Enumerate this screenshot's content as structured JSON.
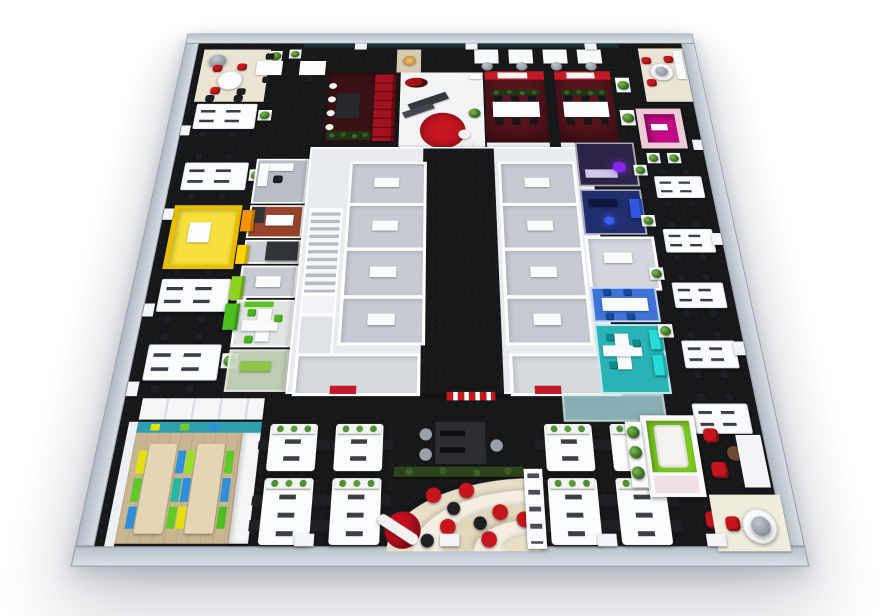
{
  "scene": {
    "kind": "3d-office-floor-plan-aerial-render",
    "background": "#ffffff"
  },
  "palette": {
    "floor_dark": "#17181a",
    "core_white": "#e9ecef",
    "room_gray": "#c6cbd3",
    "accent_red": "#c21a28",
    "rug_red": "#c81622",
    "red_room_floor": "#5a141d",
    "booth_red": "#a31220",
    "nook_floor_maroon": "#3a1216",
    "magenta": "#c30b86",
    "pink_wall": "#eccbd6",
    "purple_floor": "#2c2447",
    "purple_lamp": "#8227ec",
    "navy_floor": "#202e6e",
    "blue_bright": "#2f54e0",
    "blue_room_floor": "#3f74d6",
    "teal_room_floor": "#2ab3b6",
    "cyan_bright": "#25dcd8",
    "teal_glass": "#9cc7cd",
    "sage": "#ccdcc0",
    "orange_room_floor": "#96432b",
    "orange_bright": "#f59300",
    "yellow_pod": "#f7df3d",
    "yellow_pod_wall": "#e8be00",
    "yellow_bright": "#ffd40a",
    "lime_bright": "#8ad41c",
    "green_bright": "#4cbe1e",
    "green_pod": "#7cc820",
    "lime_table": "#9ad44c",
    "wood_floor": "#c9b691",
    "wood_table": "#e4d6b4",
    "teal_wall": "#2f9fae",
    "bench_yellow": "#e3e00e",
    "bench_green": "#5ec929",
    "bench_blue": "#2f8fd8",
    "bench_teal": "#28b8a0",
    "bench_lime": "#9adf29",
    "beige_mat": "#eae4d3",
    "cream_base": "#e9dfc9",
    "cream_light": "#f4eee1",
    "cream_mid": "#e2d6bb",
    "hedge_green": "#2c441c",
    "planter_green": "#1e3513",
    "red_furniture": "#c4161c",
    "ottoman_red": "#c01020",
    "white_furniture": "#fafbfc",
    "chair_dark": "#1e2023",
    "gray_chair": "#9aa0a8",
    "desk_dark": "#2b2d31",
    "cabinet_dark": "#303338",
    "lavender_desk": "#cfc6e8",
    "warm_lamp": "#f7c76d",
    "glass_dark": "#23414a",
    "logo_red": "#a80f14",
    "sphere_white": "#f2f2f0",
    "brown_table": "#6b4a32",
    "pod_sofa": "#f2f3ef",
    "landing_white": "#f0f2f5",
    "south_room_gray": "#d6dade",
    "white_rooms_gray": "#d3d7dd",
    "office_nook_gray": "#b9bec6",
    "cab_room_gray": "#c9ced5",
    "gray_room": "#c6cbd2",
    "green_room_floor": "#e0e4e3",
    "green_art": "#58c422",
    "teal_chair": "#0e8a8a",
    "blue_chair": "#174a9e",
    "green_chair": "#49b81e",
    "pink_mat": "#efe2e6",
    "warm_nook": "#d8cab2",
    "desk_bar_dark": "#34373c"
  },
  "zones": [
    {
      "id": "lobby",
      "label": "Reception lobby",
      "accent": "#c81622",
      "features": [
        "red round rug",
        "dark reception desk",
        "red logo wall",
        "white sphere stools"
      ]
    },
    {
      "id": "red-meeting-room-1",
      "label": "Red meeting room 1",
      "accent": "#c21a28",
      "features": [
        "red media wall",
        "white conference table",
        "planter"
      ]
    },
    {
      "id": "red-meeting-room-2",
      "label": "Red meeting room 2",
      "accent": "#c21a28",
      "features": [
        "red media wall",
        "white conference table",
        "planter"
      ]
    },
    {
      "id": "red-lounge-nook",
      "label": "Red lounge nook",
      "accent": "#a31220",
      "features": [
        "red shelving booth",
        "dark table",
        "white chairs"
      ]
    },
    {
      "id": "magenta-pod",
      "label": "Magenta meeting pod",
      "accent": "#c30b86"
    },
    {
      "id": "purple-room",
      "label": "Purple lounge room",
      "accent": "#8227ec"
    },
    {
      "id": "navy-room",
      "label": "Dark blue office",
      "accent": "#2f54e0"
    },
    {
      "id": "blue-meeting-room",
      "label": "Blue meeting room",
      "accent": "#3f74d6"
    },
    {
      "id": "teal-meeting-room",
      "label": "Teal meeting room",
      "accent": "#2ab3b6"
    },
    {
      "id": "orange-room",
      "label": "Orange office",
      "accent": "#f59300"
    },
    {
      "id": "yellow-pod",
      "label": "Yellow meeting pod",
      "accent": "#e8be00"
    },
    {
      "id": "green-meeting-room",
      "label": "Green meeting room",
      "accent": "#4cbe1e"
    },
    {
      "id": "sage-lounge",
      "label": "Sage glass lounge",
      "accent": "#ccdcc0"
    },
    {
      "id": "breakroom",
      "label": "Cafeteria breakroom",
      "accent": "#2f9fae",
      "features": [
        "wood floor",
        "two long tables",
        "colored benches"
      ]
    },
    {
      "id": "core",
      "label": "Central core with corridor and stairs",
      "accent": "#e9ecef"
    },
    {
      "id": "open-office",
      "label": "Open office bench desks",
      "accent": "#fafbfc"
    },
    {
      "id": "creative-lounge",
      "label": "Curved cream lounge with ottomans",
      "accent": "#e9dfc9",
      "features": [
        "red ottomans",
        "black ottomans",
        "display shelf"
      ]
    },
    {
      "id": "green-pod-lounge",
      "label": "Green sofa pod lounge",
      "accent": "#7cc820",
      "features": [
        "red armchairs",
        "round corner table"
      ]
    }
  ],
  "furniture_counts": {
    "perimeter_desk_clusters": 9,
    "open_office_bench_desks": 8,
    "corner_round_tables": 3,
    "red_exit_signs": 3
  }
}
